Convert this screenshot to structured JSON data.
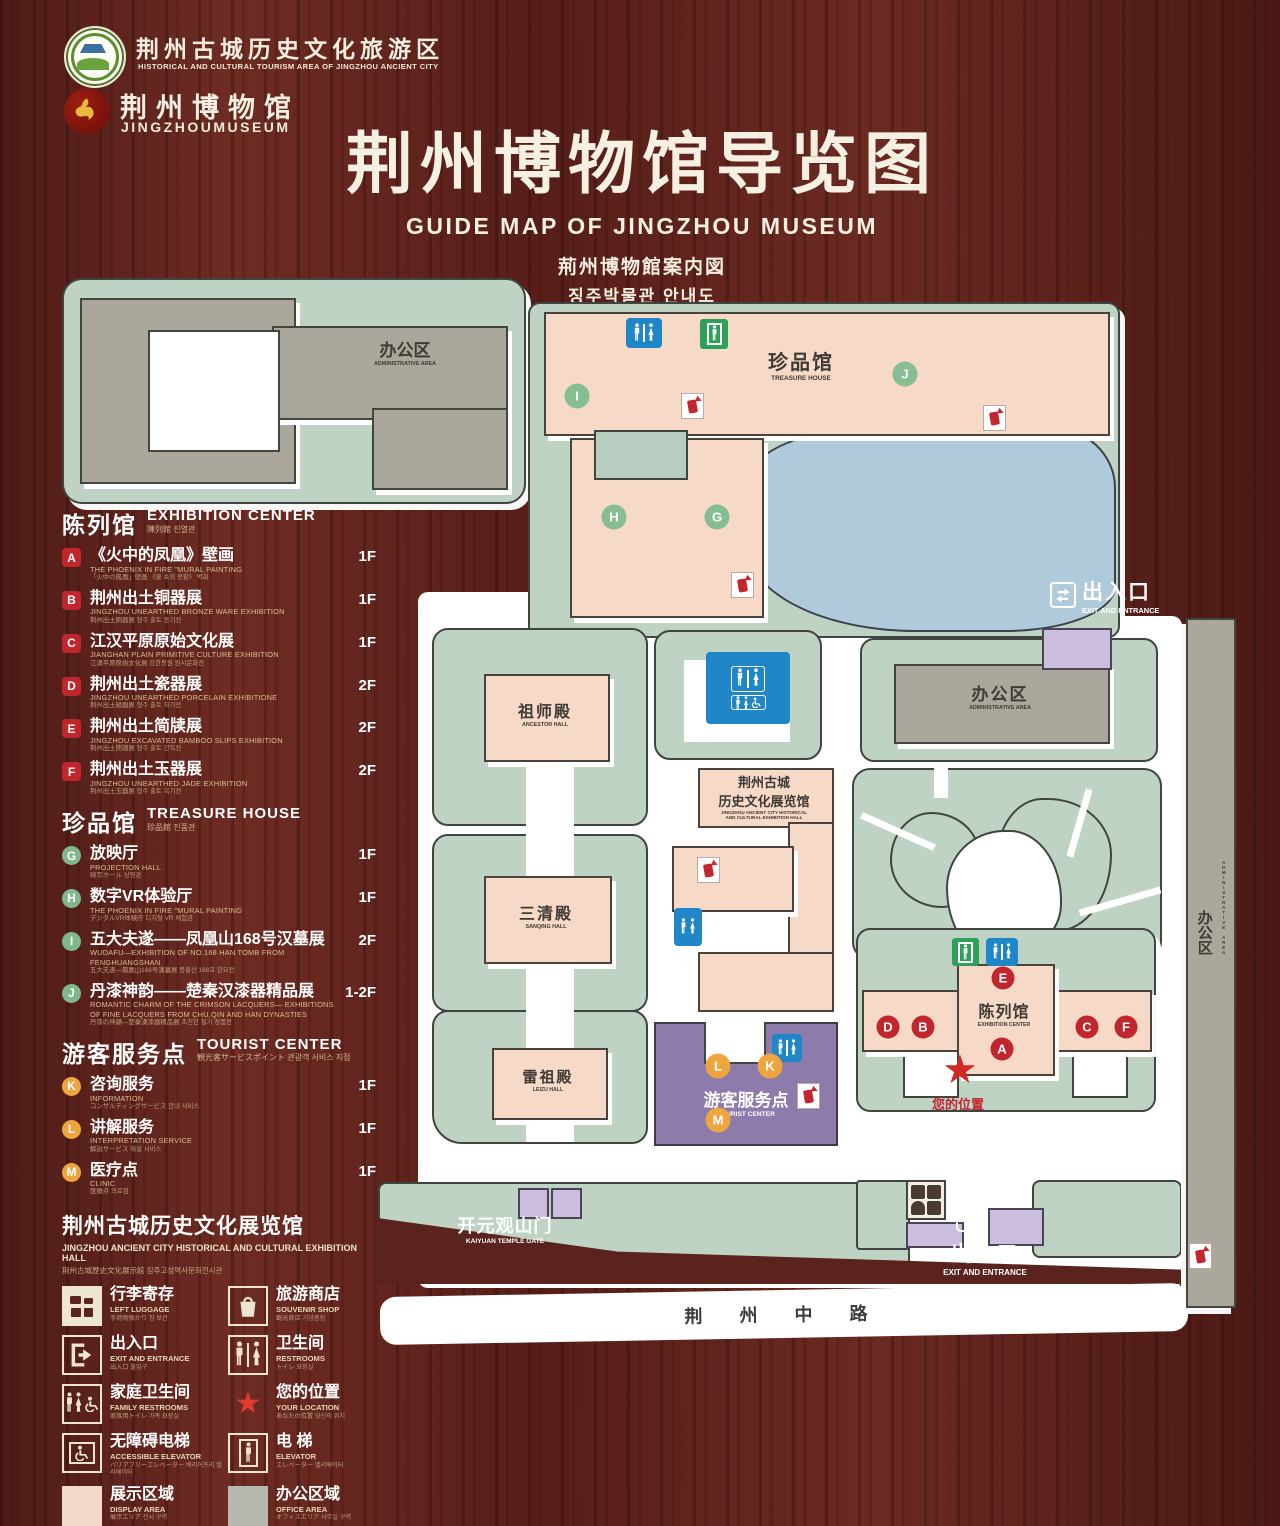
{
  "header": {
    "logo1": {
      "zh": "荆州古城历史文化旅游区",
      "en": "HISTORICAL AND CULTURAL TOURISM AREA OF JINGZHOU ANCIENT CITY"
    },
    "logo2": {
      "zh": "荆州博物馆",
      "en": "JINGZHOUMUSEUM"
    },
    "title": "荆州博物馆导览图",
    "subtitle_en": "GUIDE MAP OF JINGZHOU MUSEUM",
    "subtitle_ja": "荊州博物館案内図",
    "subtitle_ko": "징주박물관 안내도"
  },
  "legend": {
    "sections": [
      {
        "title_zh": "陈列馆",
        "title_en": "EXHIBITION CENTER",
        "title_sub": "陳列館  진열관",
        "badge_style": "red",
        "items": [
          {
            "letter": "A",
            "zh": "《火中的凤凰》壁画",
            "en": "THE PHOENIX IN FIRE \"MURAL PAINTING",
            "sub": "「火中の鳳凰」壁画  《불 속의 봉황》 벽화",
            "floor": "1F"
          },
          {
            "letter": "B",
            "zh": "荆州出土铜器展",
            "en": "JINGZHOU UNEARTHED BRONZE WARE EXHIBITION",
            "sub": "荆州出土銅器展  형주 출토 동기전",
            "floor": "1F"
          },
          {
            "letter": "C",
            "zh": "江汉平原原始文化展",
            "en": "JIANGHAN PLAIN PRIMITIVE CULTURE EXHIBITION",
            "sub": "江漢平原原始文化展  강한평원 원시문화전",
            "floor": "1F"
          },
          {
            "letter": "D",
            "zh": "荆州出土瓷器展",
            "en": "JINGZHOU UNEARTHED PORCELAIN EXHIBITIONE",
            "sub": "荆州出土磁器展  형주 출토 자기전",
            "floor": "2F"
          },
          {
            "letter": "E",
            "zh": "荆州出土简牍展",
            "en": "JINGZHOU EXCAVATED BAMBOO SLIPS EXHIBITION",
            "sub": "荆州出土簡牘展  형주 출토 간독전",
            "floor": "2F"
          },
          {
            "letter": "F",
            "zh": "荆州出土玉器展",
            "en": "JINGZHOU UNEARTHED JADE EXHIBITION",
            "sub": "荆州出土玉器展  형주 출토 옥기전",
            "floor": "2F"
          }
        ]
      },
      {
        "title_zh": "珍品馆",
        "title_en": "TREASURE HOUSE",
        "title_sub": "珍品館  진품관",
        "badge_style": "green",
        "items": [
          {
            "letter": "G",
            "zh": "放映厅",
            "en": "PROJECTION HALL",
            "sub": "映写ホール  상영관",
            "floor": "1F"
          },
          {
            "letter": "H",
            "zh": "数字VR体验厅",
            "en": "THE PHOENIX IN FIRE \"MURAL PAINTING",
            "sub": "デジタルVR体験庁  디지털 VR 체험관",
            "floor": "1F"
          },
          {
            "letter": "I",
            "zh": "五大夫遂——凤凰山168号汉墓展",
            "en": "WUDAFU—EXHIBITION OF NO.168 HAN TOMB FROM FENGHUANGSHAN",
            "sub": "五大夫遂—鳳凰山168号漢墓展  봉황산 168호 한묘전",
            "floor": "2F"
          },
          {
            "letter": "J",
            "zh": "丹漆神韵——楚秦汉漆器精品展",
            "en": "ROMANTIC CHARM OF THE CRIMSON LACQUERS— EXHIBITIONS OF FINE LACQUERS FROM CHU,QIN AND HAN DYNASTIES",
            "sub": "丹漆の神韻—楚秦漢漆器精品展  초진한 칠기 정품전",
            "floor": "1-2F"
          }
        ]
      },
      {
        "title_zh": "游客服务点",
        "title_en": "TOURIST CENTER",
        "title_sub": "観光客サービスポイント  관광객 서비스 지점",
        "badge_style": "orange",
        "items": [
          {
            "letter": "K",
            "zh": "咨询服务",
            "en": "INFORMATION",
            "sub": "コンサルティングサービス  안내 서비스",
            "floor": "1F"
          },
          {
            "letter": "L",
            "zh": "讲解服务",
            "en": "INTERPRETATION SERVICE",
            "sub": "解説サービス  해설 서비스",
            "floor": "1F"
          },
          {
            "letter": "M",
            "zh": "医疗点",
            "en": "CLINIC",
            "sub": "医療点  의료점",
            "floor": "1F"
          }
        ]
      }
    ],
    "hall_note": {
      "zh": "荆州古城历史文化展览馆",
      "en": "JINGZHOU ANCIENT CITY HISTORICAL AND CULTURAL EXHIBITION HALL",
      "sub": "荆州古城歴史文化展示館  징주고성역사문화전시관"
    },
    "symbols": [
      {
        "icon": "left-luggage",
        "zh": "行李寄存",
        "en": "LEFT LUGGAGE",
        "sub": "手荷物預かり  짐 보관"
      },
      {
        "icon": "souvenir-shop",
        "zh": "旅游商店",
        "en": "SOUVENIR SHOP",
        "sub": "観光商店  기념품점"
      },
      {
        "icon": "exit-entrance",
        "zh": "出入口",
        "en": "EXIT AND ENTRANCE",
        "sub": "出入口  출입구"
      },
      {
        "icon": "restrooms",
        "zh": "卫生间",
        "en": "RESTROOMS",
        "sub": "トイレ  화장실"
      },
      {
        "icon": "family-restrooms",
        "zh": "家庭卫生间",
        "en": "FAMILY RESTROOMS",
        "sub": "家族用トイレ  가족 화장실"
      },
      {
        "icon": "your-location",
        "zh": "您的位置",
        "en": "YOUR LOCATION",
        "sub": "あなたの位置  당신의 위치"
      },
      {
        "icon": "accessible-elevator",
        "zh": "无障碍电梯",
        "en": "ACCESSIBLE ELEVATOR",
        "sub": "バリアフリーエレベーター  배리어프리 엘리베이터"
      },
      {
        "icon": "elevator",
        "zh": "电  梯",
        "en": "ELEVATOR",
        "sub": "エレベーター  엘리베이터"
      },
      {
        "icon": "display-area",
        "zh": "展示区域",
        "en": "DISPLAY AREA",
        "sub": "展示エリア  전시 구역"
      },
      {
        "icon": "office-area",
        "zh": "办公区域",
        "en": "OFFICE AREA",
        "sub": "オフィスエリア  사무실 구역"
      }
    ]
  },
  "map": {
    "labels": {
      "admin_area_tl": {
        "zh": "办公区",
        "en": "ADMINISTRATIVE AREA"
      },
      "treasure_house": {
        "zh": "珍品馆",
        "en": "TREASURE HOUSE"
      },
      "exit_top": {
        "zh": "出入口",
        "en": "EXIT AND ENTRANCE"
      },
      "admin_area_right": {
        "zh": "办公区",
        "en": "ADMINISTRATIVE AREA"
      },
      "admin_area_side": {
        "zh": "办公区",
        "en": "ADMINISTRATIVE AREA"
      },
      "ancestor_hall": {
        "zh": "祖师殿",
        "en": "ANCESTOR HALL"
      },
      "sanqing_hall": {
        "zh": "三清殿",
        "en": "SANQING HALL"
      },
      "leizu_hall": {
        "zh": "雷祖殿",
        "en": "LEIZU HALL"
      },
      "center_hall": {
        "zh1": "荆州古城",
        "zh2": "历史文化展览馆",
        "en1": "JINGZHOU ANCIENT CITY HISTORICAL",
        "en2": "AND CULTURAL EXHIBITION HALL"
      },
      "tourist_center": {
        "zh": "游客服务点",
        "en": "TOURIST CENTER"
      },
      "exhibition_center": {
        "zh": "陈列馆",
        "en": "EXHIBITION CENTER"
      },
      "your_location": {
        "zh": "您的位置"
      },
      "kaiyuan_gate": {
        "zh": "开元观山门",
        "en": "KAIYUAN TEMPLE GATE"
      },
      "exit_bottom": {
        "zh": "出入口",
        "en": "EXIT AND ENTRANCE"
      },
      "road": {
        "zh": "荆 州 中 路"
      }
    },
    "badges": [
      {
        "letter": "I",
        "color": "green",
        "x": 577,
        "y": 396
      },
      {
        "letter": "J",
        "color": "green",
        "x": 905,
        "y": 374
      },
      {
        "letter": "H",
        "color": "green",
        "x": 614,
        "y": 517
      },
      {
        "letter": "G",
        "color": "green",
        "x": 717,
        "y": 517
      },
      {
        "letter": "E",
        "color": "red",
        "x": 1003,
        "y": 978
      },
      {
        "letter": "D",
        "color": "red",
        "x": 888,
        "y": 1027
      },
      {
        "letter": "B",
        "color": "red",
        "x": 923,
        "y": 1027
      },
      {
        "letter": "C",
        "color": "red",
        "x": 1087,
        "y": 1027
      },
      {
        "letter": "F",
        "color": "red",
        "x": 1126,
        "y": 1027
      },
      {
        "letter": "A",
        "color": "red",
        "x": 1002,
        "y": 1049
      },
      {
        "letter": "L",
        "color": "orange",
        "x": 718,
        "y": 1066
      },
      {
        "letter": "K",
        "color": "orange",
        "x": 770,
        "y": 1066
      },
      {
        "letter": "M",
        "color": "orange",
        "x": 718,
        "y": 1120
      }
    ],
    "fire_points": [
      {
        "x": 681,
        "y": 393
      },
      {
        "x": 983,
        "y": 405
      },
      {
        "x": 731,
        "y": 572
      },
      {
        "x": 697,
        "y": 857
      },
      {
        "x": 797,
        "y": 1083
      },
      {
        "x": 1189,
        "y": 1243
      }
    ],
    "icons": {
      "restroom": "man-woman-figures-on-blue",
      "family_restroom": "family-figures-on-blue",
      "elevator": "person-in-green-box",
      "fire_extinguisher": "red-extinguisher-on-white",
      "your_location": "red-star",
      "exit": "double-arrows",
      "left_luggage": "bags-on-white"
    }
  },
  "colors": {
    "wood": "#5e2421",
    "map_green": "#bfd3c5",
    "building_gray": "#aca79c",
    "building_pink": "#f7d9c8",
    "lake_blue": "#aecadb",
    "tourist_purple": "#8d7cab",
    "gate_purple": "#cabdde",
    "badge_red": "#c0262c",
    "badge_green": "#7fb88c",
    "badge_orange": "#eda63f",
    "sign_blue": "#1f87c8",
    "sign_green": "#2fa05a",
    "location_red": "#cf2b24",
    "cream": "#f6f0e2"
  }
}
